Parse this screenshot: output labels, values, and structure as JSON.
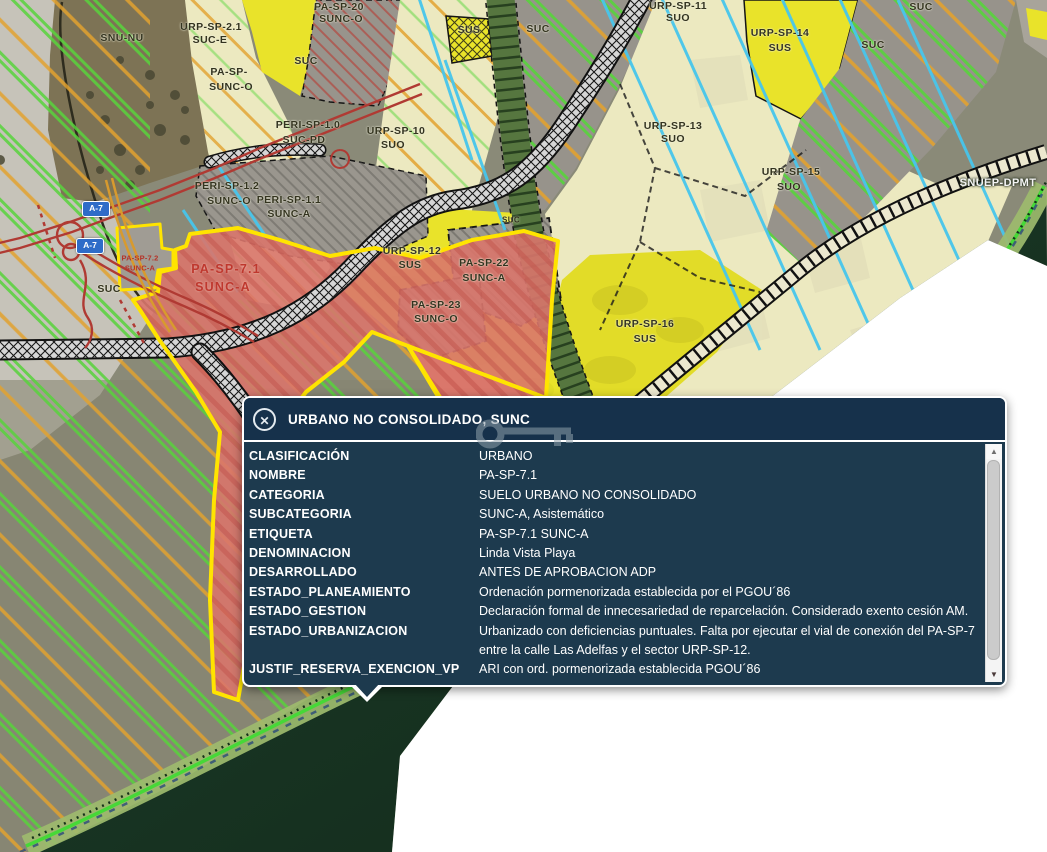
{
  "popup": {
    "title": "URBANO NO CONSOLIDADO, SUNC",
    "close_label": "✕",
    "scroll_up": "▲",
    "scroll_down": "▼",
    "rows": [
      {
        "name": "CLASIFICACIÓN",
        "value": "URBANO"
      },
      {
        "name": "NOMBRE",
        "value": "PA-SP-7.1"
      },
      {
        "name": "CATEGORIA",
        "value": "SUELO URBANO NO CONSOLIDADO"
      },
      {
        "name": "SUBCATEGORIA",
        "value": "SUNC-A, Asistemático"
      },
      {
        "name": "ETIQUETA",
        "value": "PA-SP-7.1 SUNC-A"
      },
      {
        "name": "DENOMINACION",
        "value": "Linda Vista Playa"
      },
      {
        "name": "DESARROLLADO",
        "value": "ANTES DE APROBACION ADP"
      },
      {
        "name": "ESTADO_PLANEAMIENTO",
        "value": "Ordenación pormenorizada establecida por el PGOU´86"
      },
      {
        "name": "ESTADO_GESTION",
        "value": "Declaración formal de innecesariedad de reparcelación. Considerado exento cesión AM."
      },
      {
        "name": "ESTADO_URBANIZACION",
        "value": "Urbanizado con deficiencias puntuales. Falta por ejecutar el vial de conexión del PA-SP-7 entre la calle Las Adelfas y el sector URP-SP-12."
      },
      {
        "name": "JUSTIF_RESERVA_EXENCION_VP",
        "value": "ARI con ord. pormenorizada establecida PGOU´86"
      }
    ]
  },
  "map": {
    "labels": [
      {
        "text": "SNU-NU",
        "x": 122,
        "y": 38,
        "cls": "dark"
      },
      {
        "text": "URP-SP-2.1",
        "x": 211,
        "y": 27,
        "cls": "dark"
      },
      {
        "text": "SUC-E",
        "x": 210,
        "y": 40,
        "cls": "dark"
      },
      {
        "text": "PA-SP-20",
        "x": 339,
        "y": 7,
        "cls": "dark"
      },
      {
        "text": "SUNC-O",
        "x": 341,
        "y": 19,
        "cls": "dark"
      },
      {
        "text": "SUC",
        "x": 306,
        "y": 61,
        "cls": "dark"
      },
      {
        "text": "PA-SP-",
        "x": 229,
        "y": 72,
        "cls": "dark"
      },
      {
        "text": "SUNC-O",
        "x": 231,
        "y": 87,
        "cls": "dark"
      },
      {
        "text": "PERI-SP-1.0",
        "x": 308,
        "y": 125,
        "cls": "dark"
      },
      {
        "text": "SUC-PD",
        "x": 304,
        "y": 140,
        "cls": "dark"
      },
      {
        "text": "URP-SP-10",
        "x": 396,
        "y": 131,
        "cls": "dark"
      },
      {
        "text": "SUO",
        "x": 393,
        "y": 145,
        "cls": "dark"
      },
      {
        "text": "SUS",
        "x": 469,
        "y": 30,
        "cls": "dark"
      },
      {
        "text": "SUC",
        "x": 538,
        "y": 29,
        "cls": "dark"
      },
      {
        "text": "URP-SP-11",
        "x": 678,
        "y": 6,
        "cls": "dark"
      },
      {
        "text": "SUO",
        "x": 678,
        "y": 18,
        "cls": "dark"
      },
      {
        "text": "URP-SP-14",
        "x": 780,
        "y": 33,
        "cls": "dark"
      },
      {
        "text": "SUS",
        "x": 780,
        "y": 48,
        "cls": "dark"
      },
      {
        "text": "SUC",
        "x": 921,
        "y": 7,
        "cls": "dark"
      },
      {
        "text": "SUC",
        "x": 873,
        "y": 45,
        "cls": "dark"
      },
      {
        "text": "URP-SP-13",
        "x": 673,
        "y": 126,
        "cls": "dark"
      },
      {
        "text": "SUO",
        "x": 673,
        "y": 139,
        "cls": "dark"
      },
      {
        "text": "URP-SP-15",
        "x": 791,
        "y": 172,
        "cls": "dark"
      },
      {
        "text": "SUO",
        "x": 789,
        "y": 187,
        "cls": "dark"
      },
      {
        "text": "SNUEP-DPMT",
        "x": 998,
        "y": 183,
        "cls": "white"
      },
      {
        "text": "URP-SP-12",
        "x": 412,
        "y": 251,
        "cls": "dark"
      },
      {
        "text": "SUS",
        "x": 410,
        "y": 265,
        "cls": "dark"
      },
      {
        "text": "PA-SP-22",
        "x": 484,
        "y": 263,
        "cls": "dark"
      },
      {
        "text": "SUNC-A",
        "x": 484,
        "y": 278,
        "cls": "dark"
      },
      {
        "text": "PA-SP-23",
        "x": 436,
        "y": 305,
        "cls": "dark"
      },
      {
        "text": "SUNC-O",
        "x": 436,
        "y": 319,
        "cls": "dark"
      },
      {
        "text": "SUC",
        "x": 511,
        "y": 220,
        "cls": "sm"
      },
      {
        "text": "URP-SP-16",
        "x": 645,
        "y": 324,
        "cls": "dark"
      },
      {
        "text": "SUS",
        "x": 645,
        "y": 339,
        "cls": "dark"
      },
      {
        "text": "PERI-SP-1.2",
        "x": 227,
        "y": 186,
        "cls": "dark"
      },
      {
        "text": "SUNC-O",
        "x": 229,
        "y": 201,
        "cls": "dark"
      },
      {
        "text": "PERI-SP-1.1",
        "x": 289,
        "y": 200,
        "cls": "dark"
      },
      {
        "text": "SUNC-A",
        "x": 289,
        "y": 214,
        "cls": "dark"
      },
      {
        "text": "PA-SP-7.2",
        "x": 140,
        "y": 258,
        "cls": "redsm"
      },
      {
        "text": "SUNC-A",
        "x": 140,
        "y": 268,
        "cls": "redsm"
      },
      {
        "text": "PA-SP-7.1",
        "x": 226,
        "y": 269,
        "cls": "red"
      },
      {
        "text": "SUNC-A",
        "x": 223,
        "y": 287,
        "cls": "red"
      },
      {
        "text": "SUC",
        "x": 109,
        "y": 289,
        "cls": "dark"
      }
    ],
    "road_shields": [
      {
        "text": "A-7",
        "x": 96,
        "y": 209
      },
      {
        "text": "A-7",
        "x": 90,
        "y": 246
      }
    ],
    "colors": {
      "panel_header": "#16314b",
      "panel_body": "#1d3a4e",
      "zone_yellow": "#e9e32a",
      "zone_cream": "#ece9c0",
      "zone_gray": "#97938b",
      "zone_red": "#d9766c",
      "zone_red_border": "#ffe400",
      "sea": "#16301f",
      "stripe_green": "#58d33c",
      "stripe_orange": "#e2a22f",
      "line_cyan": "#47c6ec",
      "highway_shield": "#2e6cc8"
    }
  }
}
